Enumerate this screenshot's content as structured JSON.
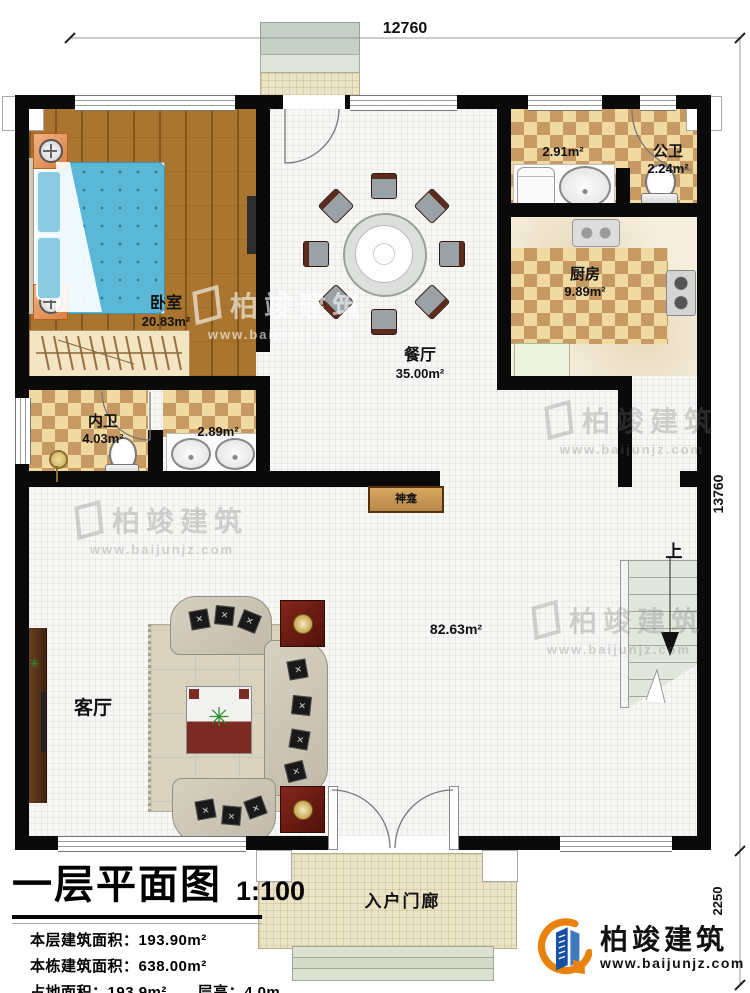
{
  "plan": {
    "dimensions": {
      "top": "12760",
      "right": "13760",
      "porch_depth": "2250"
    },
    "rooms": {
      "bedroom": {
        "name": "卧室",
        "area": "20.83m²"
      },
      "inner_bath": {
        "name": "内卫",
        "area": "4.03m²"
      },
      "vanity": {
        "area": "2.89m²"
      },
      "dining": {
        "name": "餐厅",
        "area": "35.00m²"
      },
      "laundry": {
        "area": "2.91m²"
      },
      "public_bath": {
        "name": "公卫",
        "area": "2.24m²"
      },
      "kitchen": {
        "name": "厨房",
        "area": "9.89m²"
      },
      "living": {
        "name": "客厅",
        "area": "82.63m²"
      },
      "shrine": {
        "name": "神龛"
      },
      "stairs": {
        "up_label": "上"
      },
      "porch": {
        "name": "入户门廊"
      }
    },
    "title_block": {
      "title": "一层平面图",
      "scale": "1:100",
      "rows": [
        {
          "label": "本层建筑面积：",
          "value": "193.90m²"
        },
        {
          "label": "本栋建筑面积：",
          "value": "638.00m²"
        },
        {
          "label": "占地面积：",
          "value": "193.9m²"
        },
        {
          "label": "层高：",
          "value": "4.0m"
        }
      ]
    },
    "brand": {
      "name": "柏竣建筑",
      "url": "www.baijunjz.com"
    },
    "watermark": {
      "name": "柏竣建筑",
      "url": "www.baijunjz.com"
    },
    "colors": {
      "brand_blue": "#17509e",
      "brand_orange": "#e8820c",
      "wall": "#0a0a0a"
    }
  }
}
